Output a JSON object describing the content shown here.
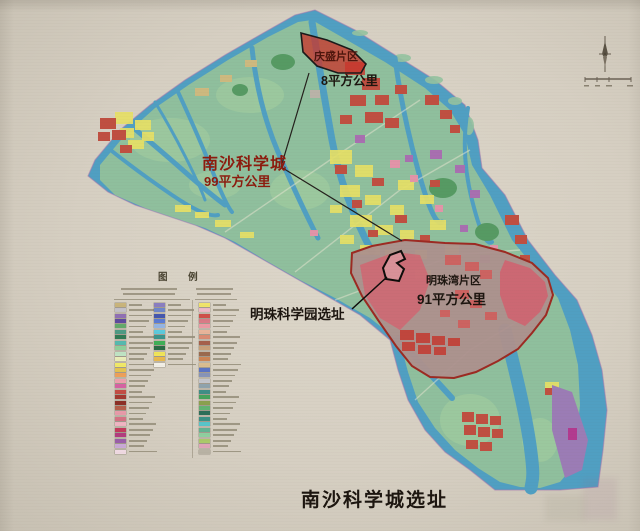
{
  "map": {
    "caption": "南沙科学城选址",
    "labels": {
      "qingsheng_name": "庆盛片区",
      "qingsheng_area": "8平方公里",
      "science_city_name": "南沙科学城",
      "science_city_area": "99平方公里",
      "mingzhu_bay_name": "明珠湾片区",
      "mingzhu_bay_area": "91平方公里",
      "science_park_label": "明珠科学园选址"
    },
    "colors": {
      "paper": "#d6cfc2",
      "water": "#509fc2",
      "land": "#8fbf9d",
      "district_highlight": "#c23b2e",
      "mingzhu_outline": "#9c2a22",
      "annotation_red": "#8c1b0e",
      "annotation_black": "#1c150f"
    },
    "icons": {
      "compass": "north-arrow-icon",
      "scale": "scale-bar"
    }
  },
  "legend": {
    "title": "图 例",
    "column1_swatches": [
      "#c9b47c",
      "#c3c0c9",
      "#8f6fb4",
      "#5e4a9e",
      "#63a96b",
      "#4d9a84",
      "#2f7a55",
      "#55b9ae",
      "#8fcf9a",
      "#bfe3c4",
      "#e9ecb8",
      "#f0e868",
      "#e3c352",
      "#eda05a",
      "#ee9fae",
      "#d562a2",
      "#c34d44",
      "#a33a31",
      "#8c2f26",
      "#b45f4b",
      "#e79aa9",
      "#d47284",
      "#efb4c2",
      "#c23a5c",
      "#b23b7e",
      "#9a5ea8",
      "#c9a9d6",
      "#efd9e2"
    ],
    "column2_swatches": [
      "#8a7ec0",
      "#6f86c9",
      "#4557ae",
      "#5b7bd4",
      "#93b4e4",
      "#5cc9dc",
      "#3a948c",
      "#3fae57",
      "#2b6b45",
      "#f0e459",
      "#e8b84e",
      "#f2efe6"
    ],
    "column3_swatches": [
      "#f0e46a",
      "#eeb9c6",
      "#cf4f49",
      "#d97a86",
      "#eb9aa4",
      "#e8b49a",
      "#d98b73",
      "#a5604b",
      "#c8a079",
      "#9a6a4f",
      "#cc8455",
      "#d9bd90",
      "#5b74c4",
      "#8794b8",
      "#c4c6cc",
      "#8fa3ad",
      "#3f8e86",
      "#46a35c",
      "#8aa04e",
      "#62b372",
      "#2d6e59",
      "#3c9186",
      "#58c4c9",
      "#63b394",
      "#8ecf9f",
      "#abc96a",
      "#e0a4b8",
      "#b8b2a4"
    ]
  }
}
